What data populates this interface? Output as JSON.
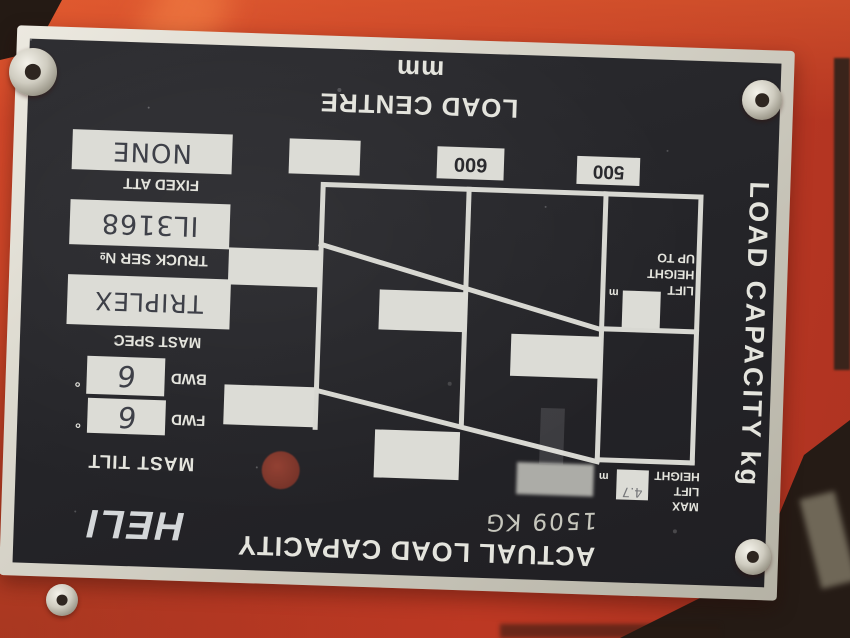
{
  "plate": {
    "brand": "HELI",
    "load_centre_title": "LOAD CENTRE mm",
    "load_capacity_title": "LOAD CAPACITY kg",
    "actual_capacity_title": "ACTUAL LOAD CAPACITY",
    "actual_capacity_value": "1509 KG",
    "load_centre_values": {
      "col1": "",
      "col2": "600",
      "col3": "500"
    },
    "lift_height_up_to": {
      "line1": "LIFT",
      "line2": "HEIGHT",
      "line3": "UP TO",
      "unit": "m"
    },
    "max_lift_height": {
      "line1": "MAX",
      "line2": "LIFT",
      "line3": "HEIGHT",
      "unit": "m",
      "value": "4.7"
    },
    "fields": {
      "fixed_att": {
        "label": "FIXED ATT",
        "value": "NONE"
      },
      "truck_ser": {
        "label": "TRUCK SER №",
        "value": "IL3168"
      },
      "mast_spec": {
        "label": "MAST SPEC",
        "value": "TRIPLEX"
      },
      "mast_tilt_label": "MAST TILT",
      "bwd": {
        "label": "BWD",
        "value": "6",
        "unit": "°"
      },
      "fwd": {
        "label": "FWD",
        "value": "6",
        "unit": "°"
      }
    }
  }
}
